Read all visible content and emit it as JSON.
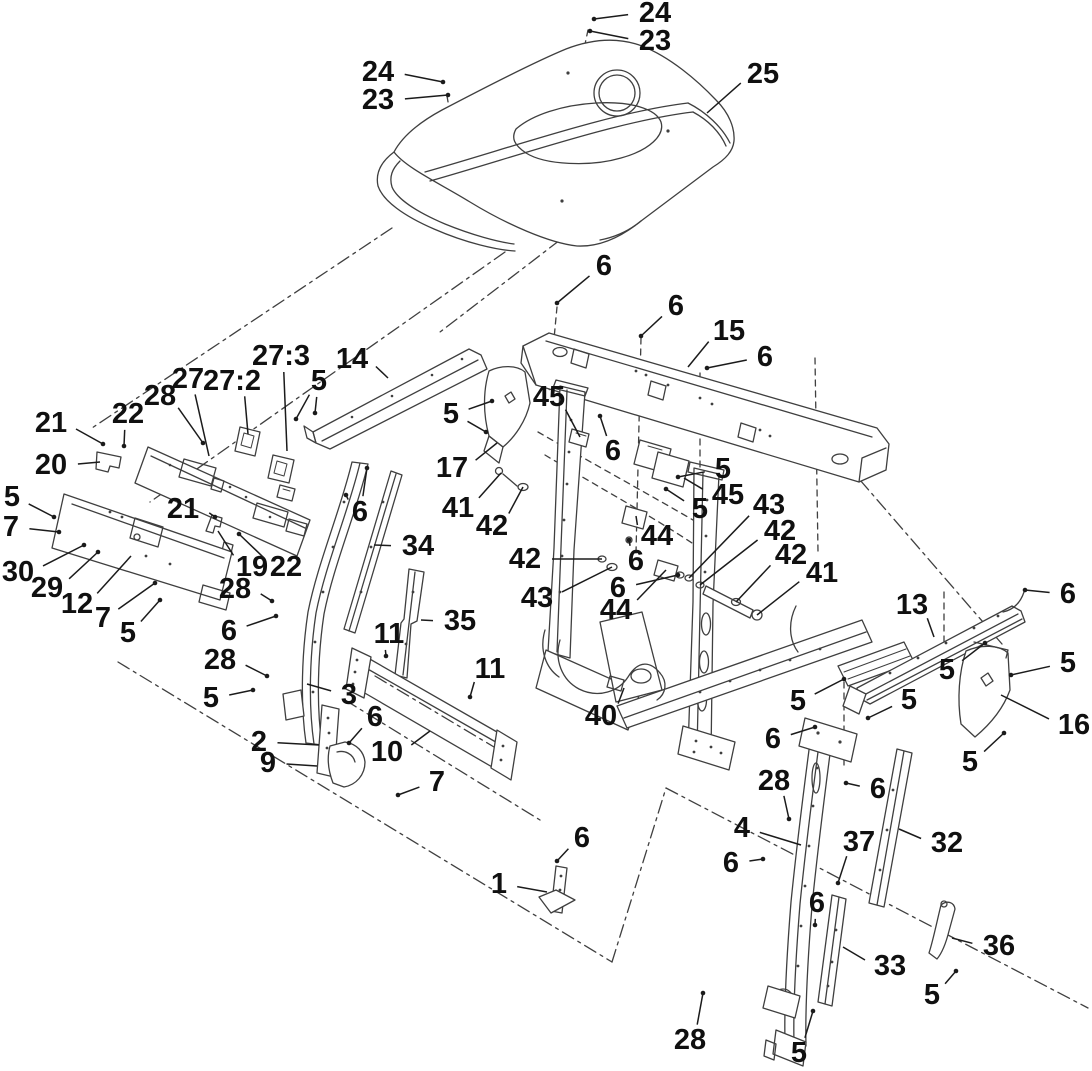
{
  "figure": {
    "kind": "exploded-parts-diagram",
    "subject": "Hood and console frame assembly exploded view",
    "background": "#ffffff",
    "line_color": "#3f3f3f",
    "leader_color": "#1b1b1b",
    "label_color": "#101010",
    "label_font_size": 29
  },
  "callouts": [
    {
      "t": "24",
      "x": 655,
      "y": 13,
      "to": [
        [
          594,
          19
        ]
      ],
      "dot": true
    },
    {
      "t": "23",
      "x": 655,
      "y": 41,
      "to": [
        [
          590,
          31
        ]
      ],
      "dot": true
    },
    {
      "t": "24",
      "x": 378,
      "y": 72,
      "to": [
        [
          443,
          82
        ]
      ],
      "dot": true
    },
    {
      "t": "23",
      "x": 378,
      "y": 100,
      "to": [
        [
          448,
          95
        ]
      ],
      "dot": true
    },
    {
      "t": "25",
      "x": 763,
      "y": 74,
      "to": [
        [
          707,
          113
        ]
      ],
      "dot": false
    },
    {
      "t": "6",
      "x": 604,
      "y": 266,
      "to": [
        [
          557,
          303
        ]
      ],
      "dot": true
    },
    {
      "t": "6",
      "x": 676,
      "y": 306,
      "to": [
        [
          641,
          336
        ]
      ],
      "dot": true
    },
    {
      "t": "15",
      "x": 729,
      "y": 331,
      "to": [
        [
          688,
          367
        ]
      ],
      "dot": false
    },
    {
      "t": "6",
      "x": 765,
      "y": 357,
      "to": [
        [
          707,
          368
        ]
      ],
      "dot": true
    },
    {
      "t": "14",
      "x": 352,
      "y": 359,
      "to": [
        [
          388,
          378
        ]
      ],
      "dot": false
    },
    {
      "t": "27:3",
      "x": 281,
      "y": 356,
      "to": [
        [
          287,
          451
        ]
      ],
      "dot": false
    },
    {
      "t": "5",
      "x": 319,
      "y": 381,
      "to": [
        [
          296,
          419
        ],
        [
          315,
          413
        ]
      ],
      "dot": true
    },
    {
      "t": "27",
      "x": 188,
      "y": 379,
      "to": [
        [
          209,
          456
        ]
      ],
      "dot": false
    },
    {
      "t": "27:2",
      "x": 232,
      "y": 381,
      "to": [
        [
          248,
          434
        ]
      ],
      "dot": false
    },
    {
      "t": "28",
      "x": 160,
      "y": 396,
      "to": [
        [
          203,
          443
        ]
      ],
      "dot": true
    },
    {
      "t": "22",
      "x": 128,
      "y": 414,
      "to": [
        [
          124,
          446
        ]
      ],
      "dot": true
    },
    {
      "t": "21",
      "x": 51,
      "y": 423,
      "to": [
        [
          103,
          444
        ]
      ],
      "dot": true
    },
    {
      "t": "20",
      "x": 51,
      "y": 465,
      "to": [
        [
          100,
          462
        ]
      ],
      "dot": false
    },
    {
      "t": "45",
      "x": 549,
      "y": 397,
      "to": [
        [
          580,
          437
        ]
      ],
      "dot": false
    },
    {
      "t": "5",
      "x": 451,
      "y": 414,
      "to": [
        [
          492,
          401
        ],
        [
          486,
          432
        ]
      ],
      "dot": true
    },
    {
      "t": "17",
      "x": 452,
      "y": 468,
      "to": [
        [
          497,
          443
        ]
      ],
      "dot": false
    },
    {
      "t": "41",
      "x": 458,
      "y": 508,
      "to": [
        [
          501,
          473
        ]
      ],
      "dot": false
    },
    {
      "t": "42",
      "x": 492,
      "y": 526,
      "to": [
        [
          523,
          487
        ]
      ],
      "dot": false
    },
    {
      "t": "6",
      "x": 613,
      "y": 451,
      "to": [
        [
          600,
          416
        ]
      ],
      "dot": true
    },
    {
      "t": "5",
      "x": 723,
      "y": 469,
      "to": [
        [
          678,
          477
        ]
      ],
      "dot": true
    },
    {
      "t": "45",
      "x": 728,
      "y": 495,
      "to": [
        [
          684,
          478
        ]
      ],
      "dot": false
    },
    {
      "t": "5",
      "x": 700,
      "y": 509,
      "to": [
        [
          666,
          489
        ]
      ],
      "dot": true
    },
    {
      "t": "43",
      "x": 769,
      "y": 505,
      "to": [
        [
          689,
          578
        ]
      ],
      "dot": false
    },
    {
      "t": "42",
      "x": 780,
      "y": 531,
      "to": [
        [
          700,
          585
        ]
      ],
      "dot": false
    },
    {
      "t": "42",
      "x": 791,
      "y": 555,
      "to": [
        [
          736,
          602
        ]
      ],
      "dot": false
    },
    {
      "t": "41",
      "x": 822,
      "y": 573,
      "to": [
        [
          757,
          615
        ]
      ],
      "dot": false
    },
    {
      "t": "44",
      "x": 657,
      "y": 536,
      "to": [
        [
          636,
          516
        ]
      ],
      "dot": false
    },
    {
      "t": "6",
      "x": 636,
      "y": 561,
      "to": [
        [
          629,
          540
        ]
      ],
      "dot": true
    },
    {
      "t": "42",
      "x": 525,
      "y": 559,
      "to": [
        [
          602,
          559
        ]
      ],
      "dot": false
    },
    {
      "t": "43",
      "x": 537,
      "y": 598,
      "to": [
        [
          612,
          567
        ]
      ],
      "dot": false
    },
    {
      "t": "6",
      "x": 618,
      "y": 588,
      "to": [
        [
          678,
          575
        ]
      ],
      "dot": true
    },
    {
      "t": "44",
      "x": 616,
      "y": 610,
      "to": [
        [
          666,
          570
        ]
      ],
      "dot": false
    },
    {
      "t": "40",
      "x": 601,
      "y": 716,
      "to": [
        [
          624,
          688
        ]
      ],
      "dot": false
    },
    {
      "t": "5",
      "x": 798,
      "y": 701,
      "to": [
        [
          844,
          679
        ]
      ],
      "dot": true
    },
    {
      "t": "6",
      "x": 773,
      "y": 739,
      "to": [
        [
          815,
          727
        ]
      ],
      "dot": true
    },
    {
      "t": "21",
      "x": 183,
      "y": 509,
      "to": [
        [
          215,
          517
        ]
      ],
      "dot": true
    },
    {
      "t": "19",
      "x": 252,
      "y": 567,
      "to": [
        [
          218,
          531
        ]
      ],
      "dot": false
    },
    {
      "t": "22",
      "x": 286,
      "y": 567,
      "to": [
        [
          239,
          534
        ]
      ],
      "dot": true
    },
    {
      "t": "5",
      "x": 12,
      "y": 497,
      "to": [
        [
          54,
          517
        ]
      ],
      "dot": true
    },
    {
      "t": "7",
      "x": 11,
      "y": 527,
      "to": [
        [
          59,
          532
        ]
      ],
      "dot": true
    },
    {
      "t": "30",
      "x": 18,
      "y": 572,
      "to": [
        [
          84,
          545
        ]
      ],
      "dot": true
    },
    {
      "t": "29",
      "x": 47,
      "y": 588,
      "to": [
        [
          98,
          552
        ]
      ],
      "dot": true
    },
    {
      "t": "12",
      "x": 77,
      "y": 604,
      "to": [
        [
          131,
          556
        ]
      ],
      "dot": false
    },
    {
      "t": "7",
      "x": 103,
      "y": 618,
      "to": [
        [
          155,
          583
        ]
      ],
      "dot": true
    },
    {
      "t": "5",
      "x": 128,
      "y": 633,
      "to": [
        [
          160,
          600
        ]
      ],
      "dot": true
    },
    {
      "t": "28",
      "x": 235,
      "y": 589,
      "to": [
        [
          272,
          601
        ]
      ],
      "dot": true
    },
    {
      "t": "6",
      "x": 229,
      "y": 631,
      "to": [
        [
          276,
          616
        ]
      ],
      "dot": true
    },
    {
      "t": "28",
      "x": 220,
      "y": 660,
      "to": [
        [
          267,
          676
        ]
      ],
      "dot": true
    },
    {
      "t": "5",
      "x": 211,
      "y": 698,
      "to": [
        [
          253,
          690
        ]
      ],
      "dot": true
    },
    {
      "t": "6",
      "x": 360,
      "y": 512,
      "to": [
        [
          346,
          495
        ],
        [
          367,
          468
        ]
      ],
      "dot": true
    },
    {
      "t": "34",
      "x": 418,
      "y": 546,
      "to": [
        [
          374,
          545
        ]
      ],
      "dot": false
    },
    {
      "t": "35",
      "x": 460,
      "y": 621,
      "to": [
        [
          421,
          620
        ]
      ],
      "dot": false
    },
    {
      "t": "11",
      "x": 389,
      "y": 634,
      "to": [
        [
          386,
          656
        ]
      ],
      "dot": true
    },
    {
      "t": "11",
      "x": 490,
      "y": 669,
      "to": [
        [
          470,
          697
        ]
      ],
      "dot": true
    },
    {
      "t": "3",
      "x": 349,
      "y": 695,
      "to": [
        [
          307,
          684
        ]
      ],
      "dot": false
    },
    {
      "t": "6",
      "x": 375,
      "y": 717,
      "to": [
        [
          349,
          743
        ]
      ],
      "dot": true
    },
    {
      "t": "10",
      "x": 387,
      "y": 752,
      "to": [
        [
          430,
          731
        ]
      ],
      "dot": false
    },
    {
      "t": "2",
      "x": 259,
      "y": 742,
      "to": [
        [
          319,
          745
        ]
      ],
      "dot": false
    },
    {
      "t": "9",
      "x": 268,
      "y": 763,
      "to": [
        [
          317,
          766
        ]
      ],
      "dot": false
    },
    {
      "t": "7",
      "x": 437,
      "y": 782,
      "to": [
        [
          398,
          795
        ]
      ],
      "dot": true
    },
    {
      "t": "1",
      "x": 499,
      "y": 884,
      "to": [
        [
          547,
          892
        ]
      ],
      "dot": false
    },
    {
      "t": "6",
      "x": 582,
      "y": 838,
      "to": [
        [
          557,
          861
        ]
      ],
      "dot": true
    },
    {
      "t": "13",
      "x": 912,
      "y": 605,
      "to": [
        [
          934,
          637
        ]
      ],
      "dot": false
    },
    {
      "t": "6",
      "x": 1068,
      "y": 594,
      "to": [
        [
          1025,
          590
        ]
      ],
      "dot": true
    },
    {
      "t": "5",
      "x": 947,
      "y": 670,
      "to": [
        [
          985,
          643
        ]
      ],
      "dot": true
    },
    {
      "t": "5",
      "x": 1068,
      "y": 663,
      "to": [
        [
          1011,
          675
        ]
      ],
      "dot": true
    },
    {
      "t": "5",
      "x": 909,
      "y": 700,
      "to": [
        [
          868,
          718
        ]
      ],
      "dot": true
    },
    {
      "t": "16",
      "x": 1074,
      "y": 725,
      "to": [
        [
          1001,
          695
        ]
      ],
      "dot": false
    },
    {
      "t": "5",
      "x": 970,
      "y": 762,
      "to": [
        [
          1004,
          733
        ]
      ],
      "dot": true
    },
    {
      "t": "28",
      "x": 774,
      "y": 781,
      "to": [
        [
          789,
          819
        ]
      ],
      "dot": true
    },
    {
      "t": "6",
      "x": 878,
      "y": 789,
      "to": [
        [
          846,
          783
        ]
      ],
      "dot": true
    },
    {
      "t": "4",
      "x": 742,
      "y": 828,
      "to": [
        [
          801,
          845
        ]
      ],
      "dot": false
    },
    {
      "t": "37",
      "x": 859,
      "y": 842,
      "to": [
        [
          838,
          883
        ]
      ],
      "dot": true
    },
    {
      "t": "32",
      "x": 947,
      "y": 843,
      "to": [
        [
          899,
          829
        ]
      ],
      "dot": false
    },
    {
      "t": "6",
      "x": 731,
      "y": 863,
      "to": [
        [
          763,
          859
        ]
      ],
      "dot": true
    },
    {
      "t": "6",
      "x": 817,
      "y": 903,
      "to": [
        [
          815,
          925
        ]
      ],
      "dot": true
    },
    {
      "t": "36",
      "x": 999,
      "y": 946,
      "to": [
        [
          952,
          938
        ]
      ],
      "dot": false
    },
    {
      "t": "33",
      "x": 890,
      "y": 966,
      "to": [
        [
          843,
          947
        ]
      ],
      "dot": false
    },
    {
      "t": "5",
      "x": 932,
      "y": 995,
      "to": [
        [
          956,
          971
        ]
      ],
      "dot": true
    },
    {
      "t": "28",
      "x": 690,
      "y": 1040,
      "to": [
        [
          703,
          993
        ]
      ],
      "dot": true
    },
    {
      "t": "5",
      "x": 799,
      "y": 1053,
      "to": [
        [
          813,
          1011
        ]
      ],
      "dot": true
    }
  ]
}
